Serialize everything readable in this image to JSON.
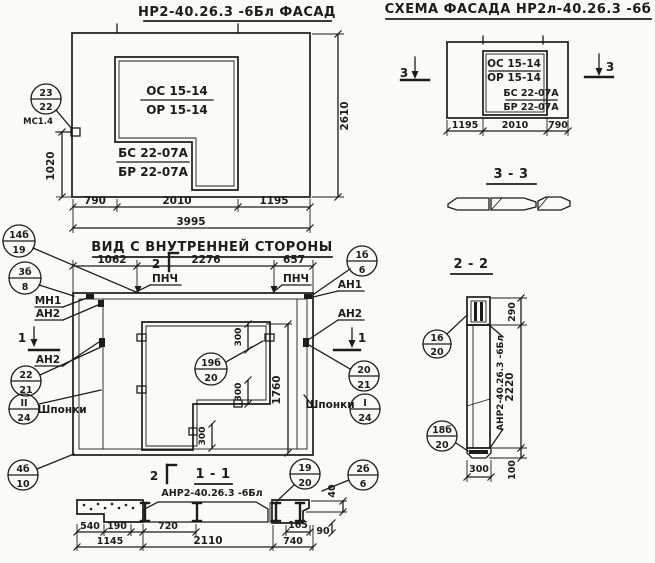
{
  "colors": {
    "paper": "#fafaf7",
    "ink": "#1c1c1c"
  },
  "facade": {
    "title": "НР2-40.26.3 -6Бл ФАСАД",
    "os": "ОС 15-14",
    "or": "ОР 15-14",
    "bs": "БС 22-07А",
    "br": "БР 22-07А",
    "callout_top": "23",
    "callout_bottom": "22",
    "marker": "МС1.4",
    "dim_height": "2610",
    "dim_left": "1020",
    "w1": "790",
    "w2": "2010",
    "w3": "1195",
    "total": "3995"
  },
  "schema": {
    "title": "СХЕМА ФАСАДА  НР2л-40.26.3 -6б",
    "os": "ОС 15-14",
    "or": "ОР 15-14",
    "bs": "БС 22-07А",
    "br": "БР 22-07А",
    "w1": "1195",
    "w2": "2010",
    "w3": "790",
    "mark": "3"
  },
  "sec33": {
    "title": "3 - 3"
  },
  "sec22": {
    "title": "2 - 2",
    "panel_label": "АНР2-40.26.3 -6Бл",
    "d1": "290",
    "d2": "2220",
    "d3": "100",
    "w": "300",
    "c16_top": "16",
    "c16_bot": "20",
    "c18_top": "18б",
    "c18_bot": "20"
  },
  "inner": {
    "title": "ВИД С ВНУТРЕННЕЙ СТОРОНЫ",
    "w1": "1062",
    "w2": "2276",
    "w3": "657",
    "mark2": "2",
    "mark1": "1",
    "pnch": "ПНЧ",
    "an1": "АН1",
    "an2": "АН2",
    "mn1": "МН1",
    "shponki": "Шпонки",
    "d300": "300",
    "d1760": "1760",
    "c14_top": "14б",
    "c14_bot": "19",
    "c3_top": "3б",
    "c3_bot": "8",
    "c22_top": "22",
    "c22_bot": "21",
    "cII_top": "II",
    "cII_bot": "24",
    "c4_top": "4б",
    "c4_bot": "10",
    "c1b_top": "1б",
    "c1b_bot": "6",
    "c20_top": "20",
    "c20_bot": "21",
    "cI_top": "I",
    "cI_bot": "24",
    "c2b_top": "2б",
    "c2b_bot": "6",
    "c19_top": "19б",
    "c19_bot": "20"
  },
  "sec11": {
    "title": "1 - 1",
    "subtitle": "АНР2-40.26.3 -6Бл",
    "mark2": "2",
    "c19_top": "19",
    "c19_bot": "20",
    "d40": "40",
    "d90": "90",
    "w540": "540",
    "w190": "190",
    "w1145": "1145",
    "w720": "720",
    "w2110": "2110",
    "w165": "165",
    "w740": "740"
  }
}
